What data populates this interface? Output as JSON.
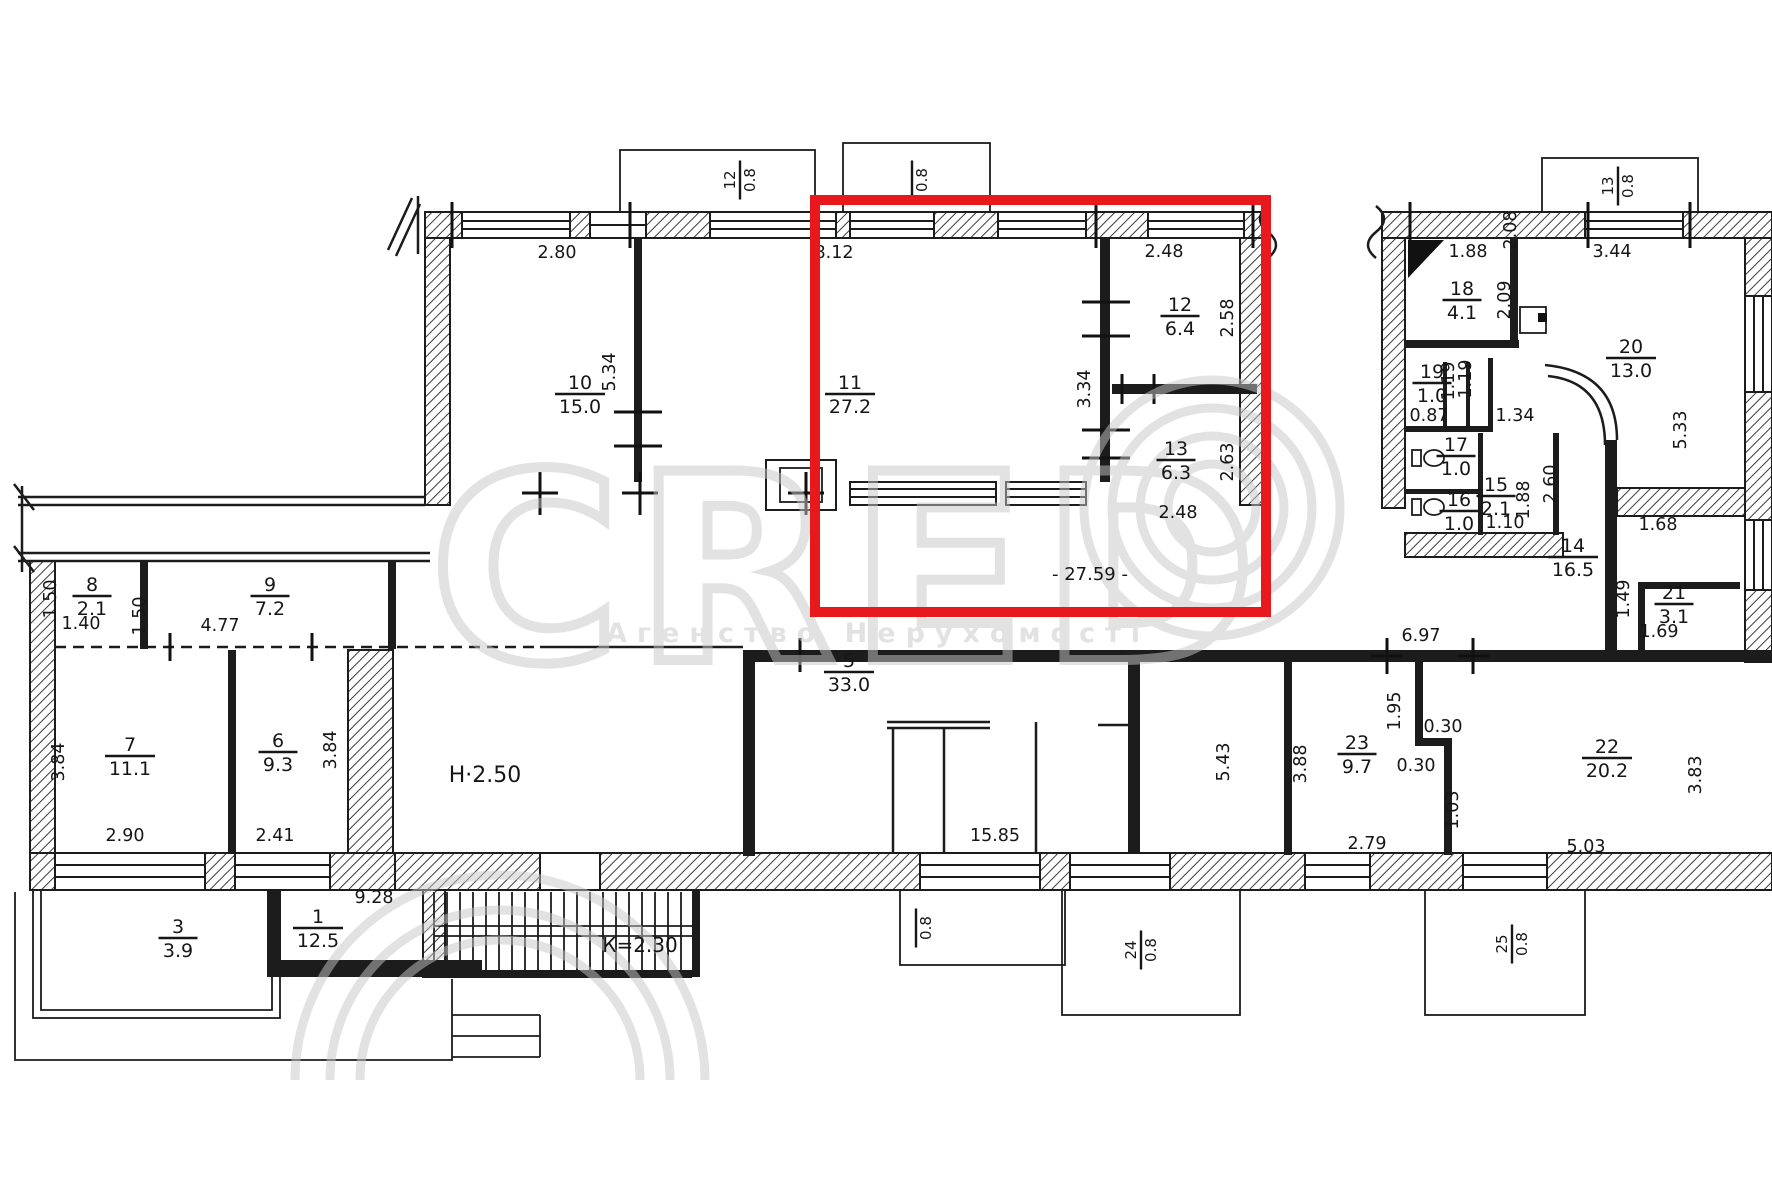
{
  "highlight": {
    "color": "#e8191c"
  },
  "watermark": {
    "brand": "CRED",
    "subtitle": "Агенство Нерухомості",
    "color": "#c7c7c7"
  },
  "rooms": [
    {
      "number": "10",
      "area": "15.0",
      "x": 580,
      "y": 394
    },
    {
      "number": "11",
      "area": "27.2",
      "x": 850,
      "y": 394
    },
    {
      "number": "12",
      "area": "6.4",
      "x": 1180,
      "y": 316
    },
    {
      "number": "13",
      "area": "6.3",
      "x": 1176,
      "y": 460
    },
    {
      "number": "5",
      "area": "33.0",
      "x": 849,
      "y": 672
    },
    {
      "number": "6",
      "area": "9.3",
      "x": 278,
      "y": 752
    },
    {
      "number": "7",
      "area": "11.1",
      "x": 130,
      "y": 756
    },
    {
      "number": "8",
      "area": "2.1",
      "x": 92,
      "y": 596
    },
    {
      "number": "9",
      "area": "7.2",
      "x": 270,
      "y": 596
    },
    {
      "number": "14",
      "area": "16.5",
      "x": 1573,
      "y": 557
    },
    {
      "number": "15",
      "area": "2.1",
      "x": 1496,
      "y": 496
    },
    {
      "number": "16",
      "area": "1.0",
      "x": 1459,
      "y": 511
    },
    {
      "number": "17",
      "area": "1.0",
      "x": 1456,
      "y": 456
    },
    {
      "number": "18",
      "area": "4.1",
      "x": 1462,
      "y": 300
    },
    {
      "number": "19",
      "area": "1.0",
      "x": 1432,
      "y": 383
    },
    {
      "number": "20",
      "area": "13.0",
      "x": 1631,
      "y": 358
    },
    {
      "number": "21",
      "area": "3.1",
      "x": 1674,
      "y": 604
    },
    {
      "number": "22",
      "area": "20.2",
      "x": 1607,
      "y": 758
    },
    {
      "number": "23",
      "area": "9.7",
      "x": 1357,
      "y": 754
    },
    {
      "number": "1",
      "area": "12.5",
      "x": 318,
      "y": 928
    },
    {
      "number": "3",
      "area": "3.9",
      "x": 178,
      "y": 938
    }
  ],
  "balconies": [
    {
      "number": "12",
      "area": "0.8",
      "x": 740,
      "y": 180,
      "rot": true
    },
    {
      "number": "",
      "area": "0.8",
      "x": 912,
      "y": 180,
      "rot": true
    },
    {
      "number": "13",
      "area": "0.8",
      "x": 1618,
      "y": 186,
      "rot": true
    },
    {
      "number": "",
      "area": "0.8",
      "x": 916,
      "y": 928,
      "rot": true
    },
    {
      "number": "24",
      "area": "0.8",
      "x": 1141,
      "y": 950,
      "rot": true
    },
    {
      "number": "25",
      "area": "0.8",
      "x": 1512,
      "y": 944,
      "rot": true
    }
  ],
  "dimensions": [
    {
      "text": "2.80",
      "x": 557,
      "y": 258,
      "rot": false
    },
    {
      "text": "8.12",
      "x": 834,
      "y": 258,
      "rot": false
    },
    {
      "text": "2.48",
      "x": 1164,
      "y": 257,
      "rot": false
    },
    {
      "text": "5.34",
      "x": 615,
      "y": 372,
      "rot": true
    },
    {
      "text": "3.34",
      "x": 1090,
      "y": 389,
      "rot": true
    },
    {
      "text": "2.58",
      "x": 1233,
      "y": 318,
      "rot": true
    },
    {
      "text": "2.63",
      "x": 1233,
      "y": 462,
      "rot": true
    },
    {
      "text": "2.48",
      "x": 1178,
      "y": 518,
      "rot": false
    },
    {
      "text": "1.88",
      "x": 1468,
      "y": 257,
      "rot": false
    },
    {
      "text": "3.44",
      "x": 1612,
      "y": 257,
      "rot": false
    },
    {
      "text": "2.08",
      "x": 1516,
      "y": 230,
      "rot": true
    },
    {
      "text": "2.09",
      "x": 1510,
      "y": 300,
      "rot": true
    },
    {
      "text": "1.19",
      "x": 1454,
      "y": 381,
      "rot": true
    },
    {
      "text": "1.19",
      "x": 1471,
      "y": 379,
      "rot": true
    },
    {
      "text": "0.87",
      "x": 1429,
      "y": 421,
      "rot": false
    },
    {
      "text": "1.34",
      "x": 1515,
      "y": 421,
      "rot": false
    },
    {
      "text": "1.10",
      "x": 1505,
      "y": 528,
      "rot": false
    },
    {
      "text": "1.88",
      "x": 1529,
      "y": 500,
      "rot": true
    },
    {
      "text": "2.60",
      "x": 1556,
      "y": 484,
      "rot": true
    },
    {
      "text": "5.33",
      "x": 1686,
      "y": 430,
      "rot": true
    },
    {
      "text": "1.68",
      "x": 1658,
      "y": 530,
      "rot": false
    },
    {
      "text": "1.49",
      "x": 1629,
      "y": 599,
      "rot": true
    },
    {
      "text": "1.69",
      "x": 1659,
      "y": 637,
      "rot": false
    },
    {
      "text": "6.97",
      "x": 1421,
      "y": 641,
      "rot": false
    },
    {
      "text": "1.95",
      "x": 1400,
      "y": 711,
      "rot": true
    },
    {
      "text": "0.30",
      "x": 1443,
      "y": 732,
      "rot": false
    },
    {
      "text": "0.30",
      "x": 1416,
      "y": 771,
      "rot": false
    },
    {
      "text": "1.03",
      "x": 1458,
      "y": 810,
      "rot": true
    },
    {
      "text": "3.88",
      "x": 1306,
      "y": 764,
      "rot": true
    },
    {
      "text": "2.79",
      "x": 1367,
      "y": 849,
      "rot": false
    },
    {
      "text": "3.83",
      "x": 1701,
      "y": 775,
      "rot": true
    },
    {
      "text": "5.03",
      "x": 1586,
      "y": 852,
      "rot": false
    },
    {
      "text": "5.43",
      "x": 1229,
      "y": 762,
      "rot": true
    },
    {
      "text": "15.85",
      "x": 995,
      "y": 841,
      "rot": false
    },
    {
      "text": "3.84",
      "x": 64,
      "y": 762,
      "rot": true
    },
    {
      "text": "3.84",
      "x": 336,
      "y": 750,
      "rot": true
    },
    {
      "text": "2.90",
      "x": 125,
      "y": 841,
      "rot": false
    },
    {
      "text": "2.41",
      "x": 275,
      "y": 841,
      "rot": false
    },
    {
      "text": "1.50",
      "x": 56,
      "y": 599,
      "rot": true
    },
    {
      "text": "1.40",
      "x": 81,
      "y": 629,
      "rot": false
    },
    {
      "text": "1.50",
      "x": 145,
      "y": 616,
      "rot": true
    },
    {
      "text": "4.77",
      "x": 220,
      "y": 631,
      "rot": false
    },
    {
      "text": "9.28",
      "x": 374,
      "y": 903,
      "rot": false
    }
  ],
  "annotations": [
    {
      "text": "Н·2.50",
      "x": 485,
      "y": 782,
      "size": 22
    },
    {
      "text": "К=2.30",
      "x": 640,
      "y": 952,
      "size": 20
    },
    {
      "text": "- 27.59 -",
      "x": 1090,
      "y": 580,
      "size": 18
    }
  ]
}
